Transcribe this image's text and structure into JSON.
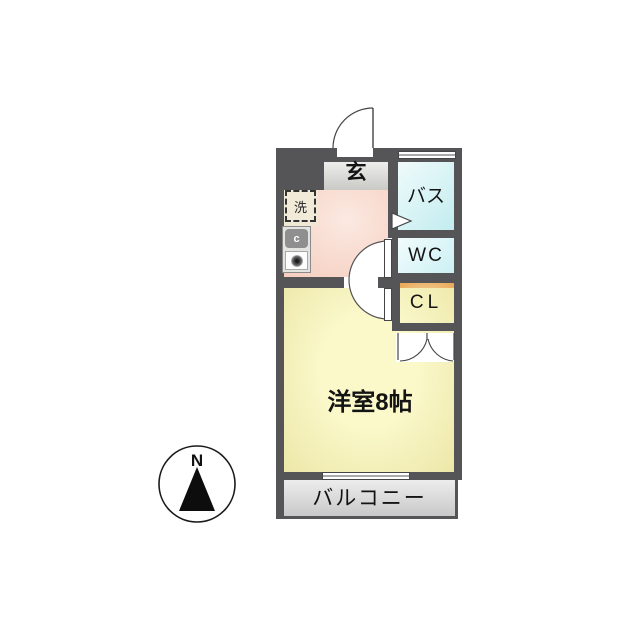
{
  "plan": {
    "type": "apartment-floor-plan",
    "rooms": {
      "genkan": {
        "label": "玄"
      },
      "bath": {
        "label": "バス"
      },
      "wc": {
        "label": "WC"
      },
      "closet": {
        "label": "CL"
      },
      "main_room": {
        "label": "洋室8帖"
      },
      "balcony": {
        "label": "バルコニー"
      }
    },
    "fixtures": {
      "washer": {
        "label": "洗"
      },
      "burner": {
        "label": "c"
      }
    },
    "compass": {
      "label": "N"
    },
    "colors": {
      "wall": "#555457",
      "genkan_floor": "#d8d8d5",
      "kitchen_floor": "#f5cdbe",
      "bath_floor": "#c3ecef",
      "wc_floor": "#ccf0f3",
      "closet_floor": "#e8a654",
      "main_room_floor": "#f8f4c0",
      "balcony_floor": "#d9d9d9",
      "background": "#ffffff"
    }
  }
}
